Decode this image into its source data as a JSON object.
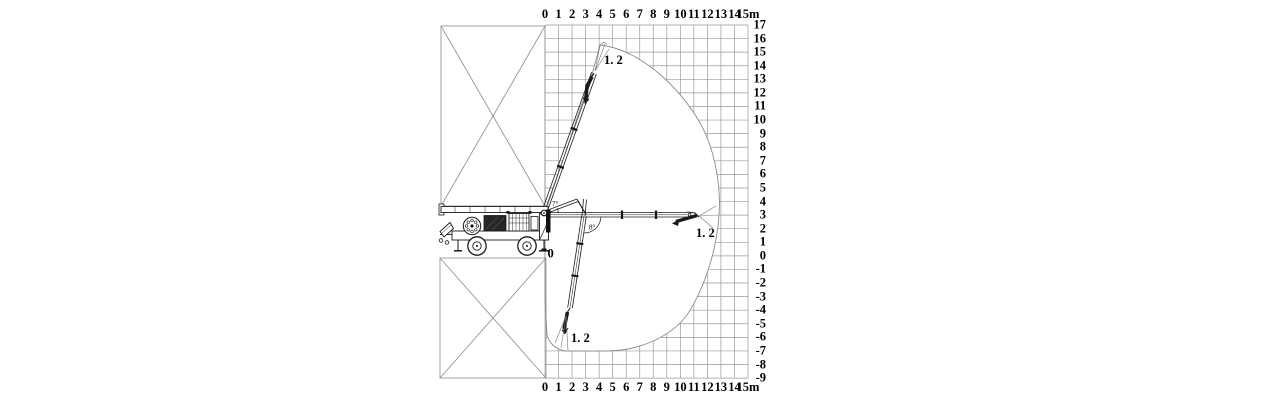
{
  "colors": {
    "background": "#ffffff",
    "grid_line": "#9a9a9a",
    "boundary_line": "#8c8c8c",
    "machine_line": "#1a1a1a",
    "text": "#000000"
  },
  "axes": {
    "x_ticks_top": [
      "0",
      "1",
      "2",
      "3",
      "4",
      "5",
      "6",
      "7",
      "8",
      "9",
      "10",
      "11",
      "12",
      "13",
      "14",
      "15m"
    ],
    "x_ticks_bottom": [
      "0",
      "1",
      "2",
      "3",
      "4",
      "5",
      "6",
      "7",
      "8",
      "9",
      "10",
      "11",
      "12",
      "13",
      "14",
      "15m"
    ],
    "y_ticks_right": [
      "17",
      "16",
      "15",
      "14",
      "13",
      "12",
      "11",
      "10",
      "9",
      "8",
      "7",
      "6",
      "5",
      "4",
      "3",
      "2",
      "1",
      "0",
      "-1",
      "-2",
      "-3",
      "-4",
      "-5",
      "-6",
      "-7",
      "-8",
      "-9"
    ],
    "origin_label": "0"
  },
  "annotations": {
    "end_hose_top": "1. 2",
    "end_hose_right": "1. 2",
    "end_hose_bottom": "1. 2",
    "angle_a": "7°",
    "angle_b": "8°"
  },
  "envelope_data": {
    "type": "working-range",
    "unit": "m",
    "max_placing_height": 15.5,
    "max_horizontal_reach": 13,
    "max_depth": -7,
    "end_hose_length": 1.2
  }
}
